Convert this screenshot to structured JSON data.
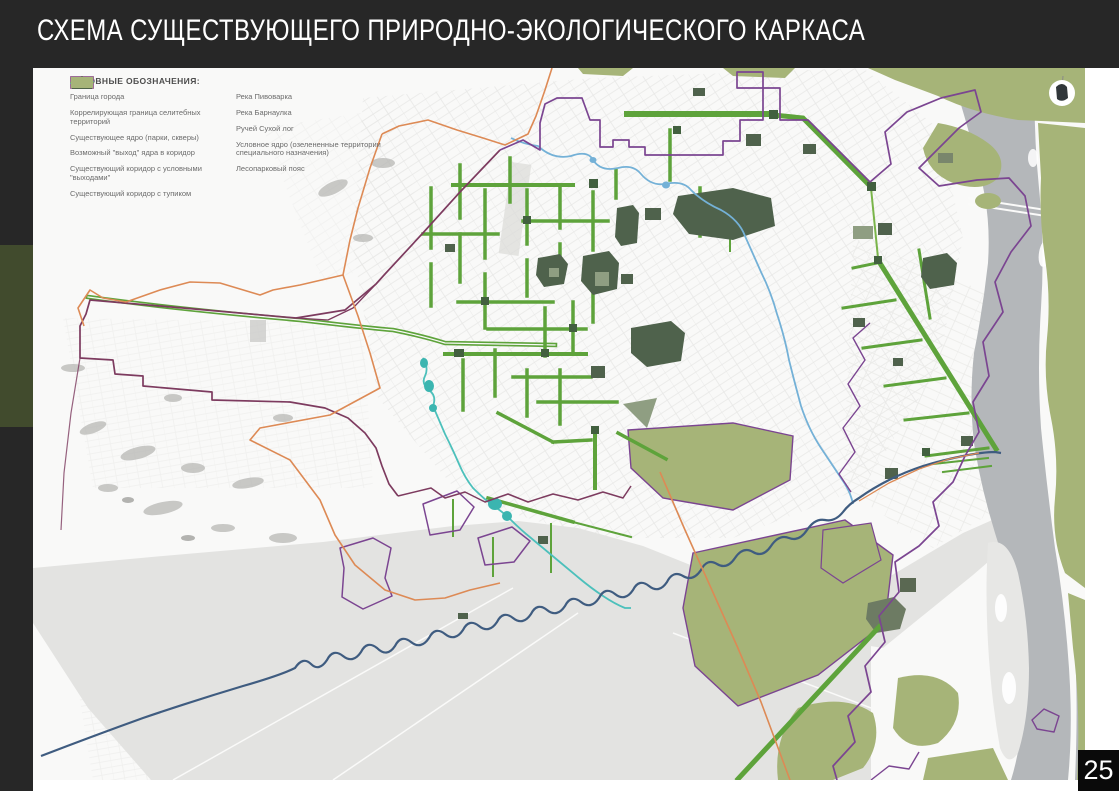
{
  "slide": {
    "title": "СХЕМА СУЩЕСТВУЮЩЕГО ПРИРОДНО-ЭКОЛОГИЧЕСКОГО КАРКАСА",
    "page_number": "25"
  },
  "legend": {
    "title": "УСЛОВНЫЕ ОБОЗНАЧЕНИЯ:",
    "left_items": [
      {
        "id": "city-boundary",
        "label": "Граница города",
        "swatch": "outline-rect",
        "color": "#dd8a55"
      },
      {
        "id": "residential-boundary",
        "label": "Коррелирующая граница селитебных территорий",
        "swatch": "outline-rect",
        "color": "#8a5a9a"
      },
      {
        "id": "existing-core",
        "label": "Существующее ядро (парки, скверы)",
        "swatch": "filled-rect",
        "color": "#55684f"
      },
      {
        "id": "core-exit",
        "label": "Возможный \"выход\" ядра в коридор",
        "swatch": "arrow-up",
        "color": "#4e6348"
      },
      {
        "id": "corridor-with-exits",
        "label": "Существующий коридор с условными \"выходами\"",
        "swatch": "arrow-double",
        "color": "#6cb33f"
      },
      {
        "id": "corridor-dead-end",
        "label": "Существующий коридор с тупиком",
        "swatch": "tee-shape",
        "color": "#6cb33f"
      }
    ],
    "right_items": [
      {
        "id": "river-pivovarka",
        "label": "Река Пивоварка",
        "swatch": "wave-line",
        "color": "#74b1d7"
      },
      {
        "id": "river-barnaulka",
        "label": "Река Барнаулка",
        "swatch": "wave-line",
        "color": "#3f5c80"
      },
      {
        "id": "creek-sukhoy-log",
        "label": "Ручей Сухой лог",
        "swatch": "wave-line",
        "color": "#4cc0bb"
      },
      {
        "id": "conditional-core",
        "label": "Условное ядро (озелененные территории специального назначения)",
        "swatch": "filled-rect",
        "color": "#8f9e82"
      },
      {
        "id": "forest-park-belt",
        "label": "Лесопарковый пояс",
        "swatch": "filled-rect",
        "color": "#a6b478"
      }
    ]
  },
  "map_palette": {
    "background": "#f9f9f8",
    "floodplain_gray": "#e3e3e1",
    "ob_river_gray": "#b4b7ba",
    "green_corridor": "#5ea33b",
    "existing_core_green": "#4f624c",
    "forest_belt_olive": "#a6b478",
    "conditional_core_sage": "#8f9e82",
    "city_boundary_orange": "#dd8a55",
    "residential_boundary_purple": "#7b4591",
    "residential_boundary_maroon": "#7d3b5f"
  }
}
